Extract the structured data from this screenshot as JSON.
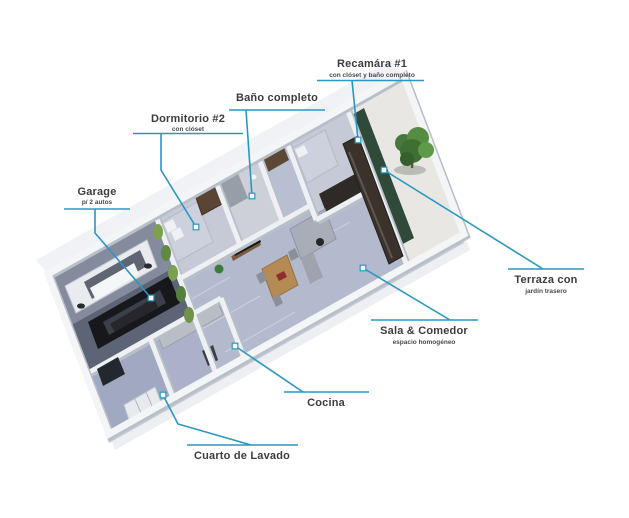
{
  "figure": {
    "kind": "isometric-floor-plan-render",
    "background": "#ffffff",
    "accent_color": "#2a96c2",
    "title_text_color": "#3d3d3d"
  },
  "labels": {
    "recamara1": {
      "title": "Recamára #1",
      "subtitle": "con clóset y baño completo"
    },
    "bano": {
      "title": "Baño completo"
    },
    "dormitorio2": {
      "title": "Dormitorio #2",
      "subtitle": "con clóset"
    },
    "garage": {
      "title": "Garage",
      "subtitle": "p/ 2 autos"
    },
    "terraza": {
      "title": "Terraza con",
      "subtitle": "jardín trasero"
    },
    "sala": {
      "title": "Sala & Comedor",
      "subtitle": "espacio homogéneo"
    },
    "cocina": {
      "title": "Cocina"
    },
    "lavado": {
      "title": "Cuarto de Lavado"
    }
  },
  "scene": {
    "rooms": [
      "Garage",
      "Cuarto de Lavado",
      "Cocina",
      "Dormitorio #2",
      "Baño completo",
      "Recamára #1",
      "Sala & Comedor",
      "Terraza con jardín trasero"
    ],
    "objects": [
      "white-suv",
      "black-car",
      "garden-tree",
      "grass-plants",
      "beds",
      "wardrobe",
      "sofa",
      "dining-table",
      "kitchen-counter",
      "laundry-machines"
    ]
  }
}
